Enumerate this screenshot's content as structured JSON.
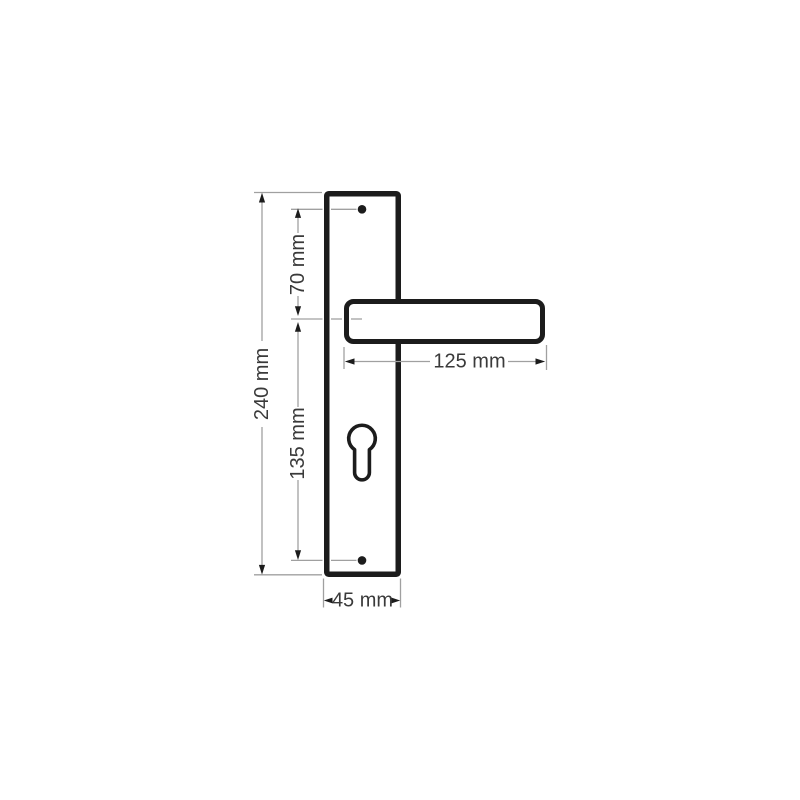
{
  "diagram": {
    "type": "technical-dimension-drawing",
    "subject": "door handle lever on long backplate with euro cylinder keyhole and two screw holes",
    "unit": "mm",
    "labels": {
      "total_height": "240 mm",
      "top_screw_to_handle_axis": "70 mm",
      "handle_axis_to_bottom_screw": "135 mm",
      "handle_length": "125 mm",
      "plate_width": "45 mm"
    },
    "values": {
      "total_height": 240,
      "top_screw_to_handle_axis": 70,
      "handle_axis_to_bottom_screw": 135,
      "handle_length": 125,
      "plate_width": 45
    },
    "colors": {
      "outline": "#1c1c1c",
      "dimension_line": "#a0a0a0",
      "label_text": "#3a3a3a",
      "background": "#ffffff"
    }
  }
}
